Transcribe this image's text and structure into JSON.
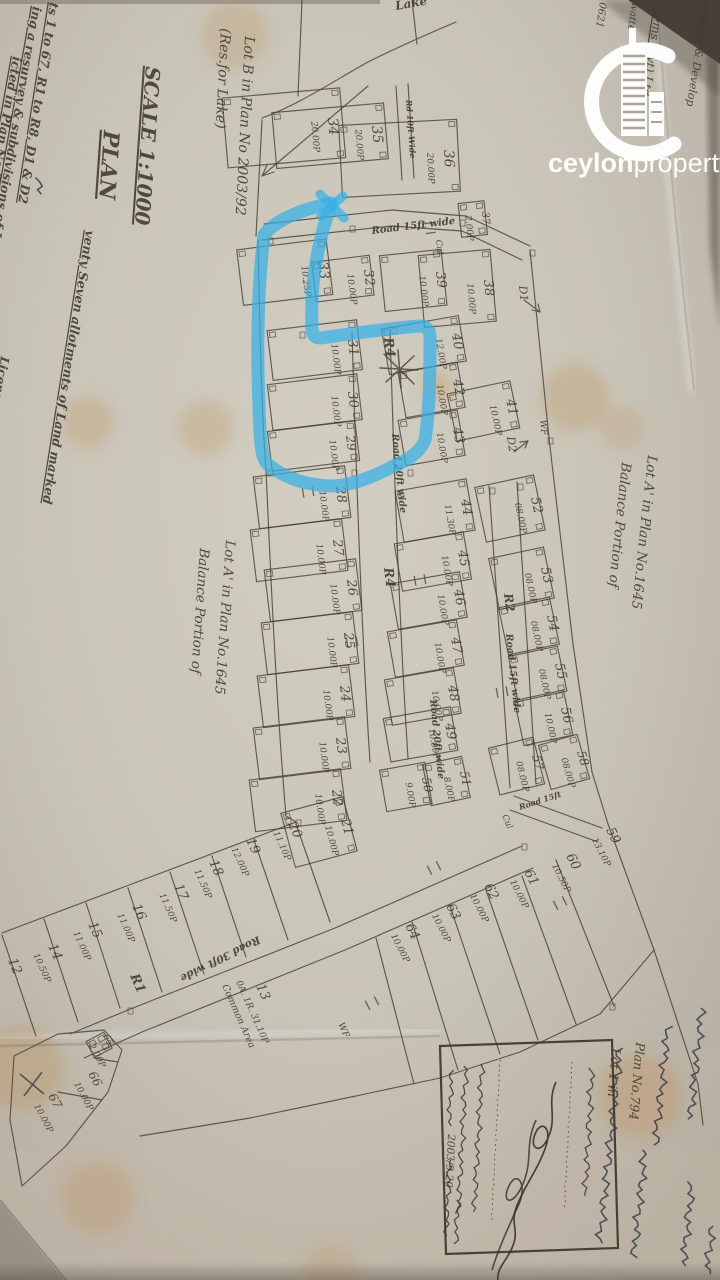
{
  "photo": {
    "highlight_color": "#33b1e8",
    "paper_color": "#c9c4b8",
    "ink_color": "#3e382d"
  },
  "watermark": {
    "bold": "ceylon",
    "regular": "property",
    "tld": ".lk"
  },
  "titles": [
    {
      "t": "SCALE 1:1000",
      "x": 146,
      "y": 66,
      "r": 94,
      "fs": 20,
      "u": true,
      "b": true
    },
    {
      "t": "PLAN",
      "x": 104,
      "y": 130,
      "r": 94,
      "fs": 22,
      "u": true,
      "b": true
    },
    {
      "t": "Lot B in Plan No 2003/92",
      "x": 245,
      "y": 36,
      "r": 93,
      "fs": 14
    },
    {
      "t": "(Res.for Lake)",
      "x": 221,
      "y": 28,
      "r": 93,
      "fs": 14
    },
    {
      "t": "Lake",
      "x": 396,
      "y": 10,
      "r": -10,
      "fs": 12,
      "b": true
    },
    {
      "t": "venty Seven allotments of Land marked",
      "x": 86,
      "y": 230,
      "r": 99,
      "fs": 12.5,
      "u": true,
      "b": true
    },
    {
      "t": "ts 1 to 67, R1 to R8, D1 & D2",
      "x": 50,
      "y": 2,
      "r": 99,
      "fs": 12.5,
      "u": true,
      "b": true
    },
    {
      "t": "ing a resurvey & subdivisions of Lot A",
      "x": 33,
      "y": 6,
      "r": 100,
      "fs": 12.5,
      "u": true,
      "b": true
    },
    {
      "t": "icted in Plan No.2003/92ᴮ dated 25th July, 2003",
      "x": 13,
      "y": 56,
      "r": 100,
      "fs": 12.5,
      "u": true,
      "b": true
    },
    {
      "t": "Licensed Surveyor",
      "x": 1,
      "y": 356,
      "r": 100,
      "fs": 12,
      "b": true
    },
    {
      "t": "Balance Portion of",
      "x": 200,
      "y": 548,
      "r": 94,
      "fs": 13.5
    },
    {
      "t": "Lot A' in Plan No.1645",
      "x": 226,
      "y": 540,
      "r": 94,
      "fs": 13.5
    },
    {
      "t": "Balance Portion of",
      "x": 622,
      "y": 462,
      "r": 96,
      "fs": 13.5
    },
    {
      "t": "Lot A' in Plan No.1645",
      "x": 648,
      "y": 455,
      "r": 96,
      "fs": 13.5
    },
    {
      "t": "Lot 1 in",
      "x": 612,
      "y": 1048,
      "r": 95,
      "fs": 12.5
    },
    {
      "t": "Plan No.794",
      "x": 636,
      "y": 1042,
      "r": 95,
      "fs": 12.5
    },
    {
      "t": "0A. 1R. 31.10P",
      "x": 236,
      "y": 982,
      "r": 66,
      "fs": 9
    },
    {
      "t": "Common Area",
      "x": 222,
      "y": 986,
      "r": 66,
      "fs": 9.5
    },
    {
      "t": "0621",
      "x": 600,
      "y": 2,
      "r": 99,
      "fs": 10
    },
    {
      "t": "watte",
      "x": 632,
      "y": 2,
      "r": 99,
      "fs": 10
    },
    {
      "t": "stems (Pvt) Ltd.",
      "x": 656,
      "y": 4,
      "r": 99,
      "fs": 12,
      "u": true
    },
    {
      "t": "urveyor & Develop",
      "x": 703,
      "y": 2,
      "r": 99,
      "fs": 11
    }
  ],
  "markers": [
    {
      "t": "R4",
      "x": 384,
      "y": 338,
      "r": 83,
      "fs": 13,
      "b": true
    },
    {
      "t": "R4",
      "x": 384,
      "y": 568,
      "r": 83,
      "fs": 13,
      "b": true
    },
    {
      "t": "R1",
      "x": 130,
      "y": 976,
      "r": 66,
      "fs": 13,
      "b": true
    },
    {
      "t": "R2",
      "x": 504,
      "y": 594,
      "r": 82,
      "fs": 12,
      "b": true
    },
    {
      "t": "D1",
      "x": 519,
      "y": 286,
      "r": 84,
      "fs": 11
    },
    {
      "t": "D2",
      "x": 507,
      "y": 437,
      "r": 82,
      "fs": 11
    },
    {
      "t": "WF",
      "x": 540,
      "y": 420,
      "r": 84,
      "fs": 9
    },
    {
      "t": "WF",
      "x": 338,
      "y": 1024,
      "r": 66,
      "fs": 9
    },
    {
      "t": "Cul",
      "x": 436,
      "y": 240,
      "r": 84,
      "fs": 8.5
    },
    {
      "t": "Cul",
      "x": 502,
      "y": 816,
      "r": 66,
      "fs": 8.5
    }
  ],
  "roads": [
    {
      "t": "Road 15ft wide",
      "x": 372,
      "y": 234,
      "r": -7,
      "fs": 10,
      "b": true
    },
    {
      "t": "Road 15ft wide",
      "x": 506,
      "y": 634,
      "r": 84,
      "fs": 9.5,
      "b": true
    },
    {
      "t": "Road 20ft wide",
      "x": 392,
      "y": 434,
      "r": 84,
      "fs": 9.5,
      "b": true
    },
    {
      "t": "Road 20ft wide",
      "x": 430,
      "y": 700,
      "r": 84,
      "fs": 9.5,
      "b": true
    },
    {
      "t": "Road 30ft wide",
      "x": 258,
      "y": 936,
      "r": 153,
      "fs": 10.5,
      "b": true
    },
    {
      "t": "Rd 10ft Wide",
      "x": 406,
      "y": 100,
      "r": 86,
      "fs": 8,
      "b": true
    },
    {
      "t": "Road 15ft",
      "x": 520,
      "y": 810,
      "r": -18,
      "fs": 8,
      "b": true
    }
  ],
  "lots": [
    {
      "n": "33",
      "a": "10.25P",
      "x": 318,
      "y": 262,
      "r": 83,
      "fs": 14,
      "dw": 56,
      "dd": 90
    },
    {
      "n": "32",
      "a": "10.00P",
      "x": 364,
      "y": 270,
      "r": 83,
      "fs": 13,
      "dw": 40,
      "dd": 58
    },
    {
      "n": "31",
      "a": "10.00P",
      "x": 348,
      "y": 340,
      "r": 83,
      "fs": 13,
      "dw": 50,
      "dd": 90
    },
    {
      "n": "30",
      "a": "10.00P",
      "x": 348,
      "y": 392,
      "r": 83,
      "fs": 13,
      "dw": 46,
      "dd": 90
    },
    {
      "n": "29",
      "a": "10.00P",
      "x": 346,
      "y": 436,
      "r": 83,
      "fs": 12,
      "dw": 40,
      "dd": 88
    },
    {
      "n": "28",
      "a": "10.00P",
      "x": 336,
      "y": 487,
      "r": 83,
      "fs": 13,
      "dw": 52,
      "dd": 92
    },
    {
      "n": "27",
      "a": "10.00P",
      "x": 333,
      "y": 540,
      "r": 83,
      "fs": 13,
      "dw": 52,
      "dd": 92
    },
    {
      "n": "26",
      "a": "10.00P",
      "x": 347,
      "y": 580,
      "r": 83,
      "fs": 13,
      "dw": 52,
      "dd": 92
    },
    {
      "n": "25",
      "a": "10.00P",
      "x": 344,
      "y": 633,
      "r": 83,
      "fs": 13,
      "dw": 52,
      "dd": 92
    },
    {
      "n": "24",
      "a": "10.00P",
      "x": 340,
      "y": 686,
      "r": 83,
      "fs": 13,
      "dw": 52,
      "dd": 92
    },
    {
      "n": "23",
      "a": "10.00P",
      "x": 336,
      "y": 738,
      "r": 83,
      "fs": 13,
      "dw": 52,
      "dd": 92
    },
    {
      "n": "22",
      "a": "10.00P",
      "x": 332,
      "y": 790,
      "r": 83,
      "fs": 13,
      "dw": 52,
      "dd": 92
    },
    {
      "n": "21",
      "a": "10.00P",
      "x": 341,
      "y": 820,
      "r": 75,
      "fs": 13,
      "dw": 56,
      "dd": 64
    },
    {
      "n": "34",
      "a": "20.00P",
      "x": 328,
      "y": 118,
      "r": 85,
      "fs": 14,
      "dw": 70,
      "dd": 118
    },
    {
      "n": "35",
      "a": "20.00P",
      "x": 372,
      "y": 126,
      "r": 85,
      "fs": 14,
      "dw": 56,
      "dd": 112
    },
    {
      "n": "36",
      "a": "20.00P",
      "x": 444,
      "y": 150,
      "r": 87,
      "fs": 14,
      "dw": 72,
      "dd": 118
    },
    {
      "n": "37",
      "a": "2.00P",
      "x": 482,
      "y": 212,
      "r": 84,
      "fs": 10,
      "dw": 34,
      "dd": 26
    },
    {
      "n": "38",
      "a": "10.00P",
      "x": 484,
      "y": 280,
      "r": 85,
      "fs": 13,
      "dw": 72,
      "dd": 72
    },
    {
      "n": "39",
      "a": "10.00P",
      "x": 436,
      "y": 272,
      "r": 84,
      "fs": 13,
      "dw": 56,
      "dd": 62
    },
    {
      "n": "40",
      "a": "12.00P",
      "x": 452,
      "y": 334,
      "r": 80,
      "fs": 13,
      "dw": 46,
      "dd": 78
    },
    {
      "n": "41",
      "a": "10.00P",
      "x": 506,
      "y": 400,
      "r": 78,
      "fs": 13,
      "dw": 48,
      "dd": 64
    },
    {
      "n": "42",
      "a": "10.00P",
      "x": 453,
      "y": 380,
      "r": 80,
      "fs": 13,
      "dw": 46,
      "dd": 60
    },
    {
      "n": "43",
      "a": "10.00P",
      "x": 453,
      "y": 428,
      "r": 80,
      "fs": 13,
      "dw": 46,
      "dd": 60
    },
    {
      "n": "44",
      "a": "11.30P",
      "x": 461,
      "y": 500,
      "r": 80,
      "fs": 13,
      "dw": 52,
      "dd": 72
    },
    {
      "n": "45",
      "a": "10.00P",
      "x": 458,
      "y": 551,
      "r": 80,
      "fs": 13,
      "dw": 48,
      "dd": 70
    },
    {
      "n": "46",
      "a": "10.00P",
      "x": 454,
      "y": 590,
      "r": 80,
      "fs": 13,
      "dw": 46,
      "dd": 70
    },
    {
      "n": "47",
      "a": "10.00P",
      "x": 451,
      "y": 638,
      "r": 80,
      "fs": 13,
      "dw": 46,
      "dd": 70
    },
    {
      "n": "48",
      "a": "10.00P",
      "x": 448,
      "y": 686,
      "r": 80,
      "fs": 13,
      "dw": 46,
      "dd": 70
    },
    {
      "n": "49",
      "a": "10.00P",
      "x": 445,
      "y": 724,
      "r": 80,
      "fs": 13,
      "dw": 44,
      "dd": 68
    },
    {
      "n": "50",
      "a": "9.00P",
      "x": 422,
      "y": 778,
      "r": 80,
      "fs": 12,
      "dw": 42,
      "dd": 46
    },
    {
      "n": "51",
      "a": "8.00P",
      "x": 460,
      "y": 772,
      "r": 78,
      "fs": 12,
      "dw": 42,
      "dd": 40
    },
    {
      "n": "52",
      "a": "08.00P",
      "x": 531,
      "y": 498,
      "r": 78,
      "fs": 13,
      "dw": 56,
      "dd": 60
    },
    {
      "n": "53",
      "a": "08.00P",
      "x": 541,
      "y": 568,
      "r": 78,
      "fs": 13,
      "dw": 52,
      "dd": 56
    },
    {
      "n": "54",
      "a": "08.00P",
      "x": 547,
      "y": 616,
      "r": 78,
      "fs": 13,
      "dw": 48,
      "dd": 52
    },
    {
      "n": "55",
      "a": "08.00P",
      "x": 555,
      "y": 664,
      "r": 78,
      "fs": 13,
      "dw": 46,
      "dd": 50
    },
    {
      "n": "56",
      "a": "10.00P",
      "x": 561,
      "y": 708,
      "r": 78,
      "fs": 13,
      "dw": 46,
      "dd": 50
    },
    {
      "n": "57",
      "a": "08.00P",
      "x": 532,
      "y": 756,
      "r": 76,
      "fs": 12,
      "dw": 48,
      "dd": 46
    },
    {
      "n": "58",
      "a": "08.00P",
      "x": 577,
      "y": 752,
      "r": 74,
      "fs": 12,
      "dw": 46,
      "dd": 40
    },
    {
      "n": "59",
      "a": "13.10P",
      "x": 606,
      "y": 830,
      "r": 63,
      "fs": 13,
      "dw": 0,
      "dd": 0
    },
    {
      "n": "60",
      "a": "10.50P",
      "x": 566,
      "y": 856,
      "r": 63,
      "fs": 13,
      "dw": 0,
      "dd": 0
    },
    {
      "n": "61",
      "a": "10.00P",
      "x": 524,
      "y": 872,
      "r": 63,
      "fs": 13,
      "dw": 0,
      "dd": 0
    },
    {
      "n": "62",
      "a": "10.00P",
      "x": 484,
      "y": 886,
      "r": 63,
      "fs": 13,
      "dw": 0,
      "dd": 0
    },
    {
      "n": "63",
      "a": "10.00P",
      "x": 446,
      "y": 906,
      "r": 63,
      "fs": 13,
      "dw": 0,
      "dd": 0
    },
    {
      "n": "64",
      "a": "10.00P",
      "x": 405,
      "y": 926,
      "r": 63,
      "fs": 13,
      "dw": 0,
      "dd": 0
    },
    {
      "n": "20",
      "a": "11.10P",
      "x": 288,
      "y": 824,
      "r": 66,
      "fs": 13,
      "dw": 0,
      "dd": 0
    },
    {
      "n": "19",
      "a": "12.00P",
      "x": 246,
      "y": 840,
      "r": 66,
      "fs": 13,
      "dw": 0,
      "dd": 0
    },
    {
      "n": "18",
      "a": "11.50P",
      "x": 209,
      "y": 862,
      "r": 66,
      "fs": 13,
      "dw": 0,
      "dd": 0
    },
    {
      "n": "17",
      "a": "11.50P",
      "x": 174,
      "y": 886,
      "r": 66,
      "fs": 13,
      "dw": 0,
      "dd": 0
    },
    {
      "n": "16",
      "a": "11.00P",
      "x": 132,
      "y": 906,
      "r": 66,
      "fs": 13,
      "dw": 0,
      "dd": 0
    },
    {
      "n": "15",
      "a": "11.00P",
      "x": 88,
      "y": 924,
      "r": 66,
      "fs": 13,
      "dw": 0,
      "dd": 0
    },
    {
      "n": "14",
      "a": "10.50P",
      "x": 48,
      "y": 946,
      "r": 66,
      "fs": 13,
      "dw": 0,
      "dd": 0
    },
    {
      "n": "12",
      "a": "",
      "x": 8,
      "y": 960,
      "r": 68,
      "fs": 13,
      "dw": 0,
      "dd": 0
    },
    {
      "n": "13",
      "a": "",
      "x": 256,
      "y": 986,
      "r": 66,
      "fs": 13,
      "dw": 0,
      "dd": 0
    },
    {
      "n": "65",
      "a": "2.00P",
      "x": 103,
      "y": 1036,
      "r": 62,
      "fs": 9,
      "dw": 18,
      "dd": 20
    },
    {
      "n": "66",
      "a": "10.00P",
      "x": 88,
      "y": 1074,
      "r": 62,
      "fs": 12,
      "dw": 0,
      "dd": 0
    },
    {
      "n": "67",
      "a": "10.00P",
      "x": 48,
      "y": 1096,
      "r": 62,
      "fs": 12,
      "dw": 0,
      "dd": 0
    }
  ],
  "stamp": {
    "approval_note": "අනුමත කරමි.",
    "department_lines": [
      "ලංකා දෙපාර්තමේන්තුව",
      "සැලසුම් බලධාරී ලවා:ව",
      "දින 2003/9.20",
      "රම කාර්යාලයේ කැල්ඹ.ව."
    ],
    "date_number": "2003/9.20"
  },
  "handwriting_note": "sinhala-handwritten-annotations"
}
